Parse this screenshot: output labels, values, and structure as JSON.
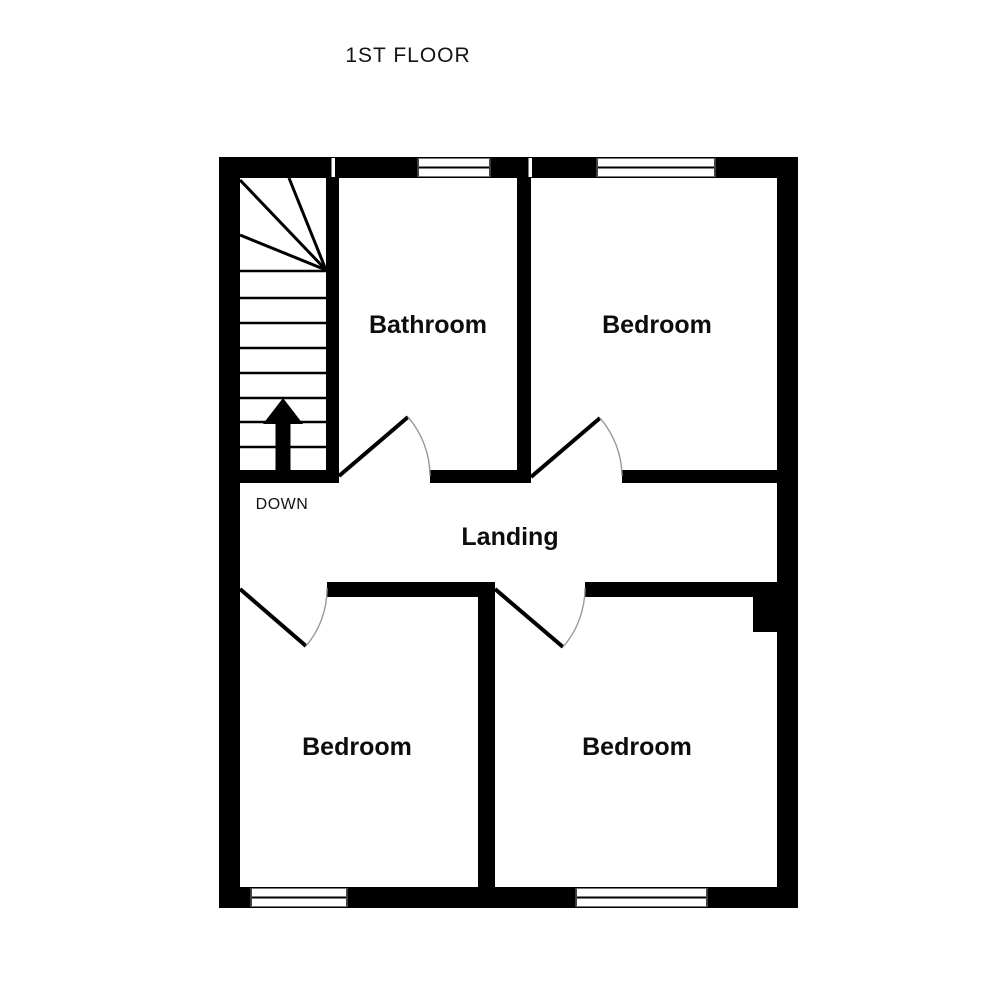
{
  "title": "1ST FLOOR",
  "floor_plan": {
    "rooms": [
      {
        "id": "bathroom",
        "label": "Bathroom"
      },
      {
        "id": "bedroom-top-right",
        "label": "Bedroom"
      },
      {
        "id": "landing",
        "label": "Landing"
      },
      {
        "id": "bedroom-bottom-left",
        "label": "Bedroom"
      },
      {
        "id": "bedroom-bottom-right",
        "label": "Bedroom"
      }
    ],
    "stairs": {
      "label": "DOWN",
      "direction_icon": "up-arrow",
      "straight_treads": 8,
      "winder_treads": 4
    },
    "window_count": 4,
    "door_count": 4,
    "colors": {
      "wall": "#000000",
      "background": "#ffffff",
      "door_swing": "#9a9a9a",
      "text": "#141414"
    }
  }
}
